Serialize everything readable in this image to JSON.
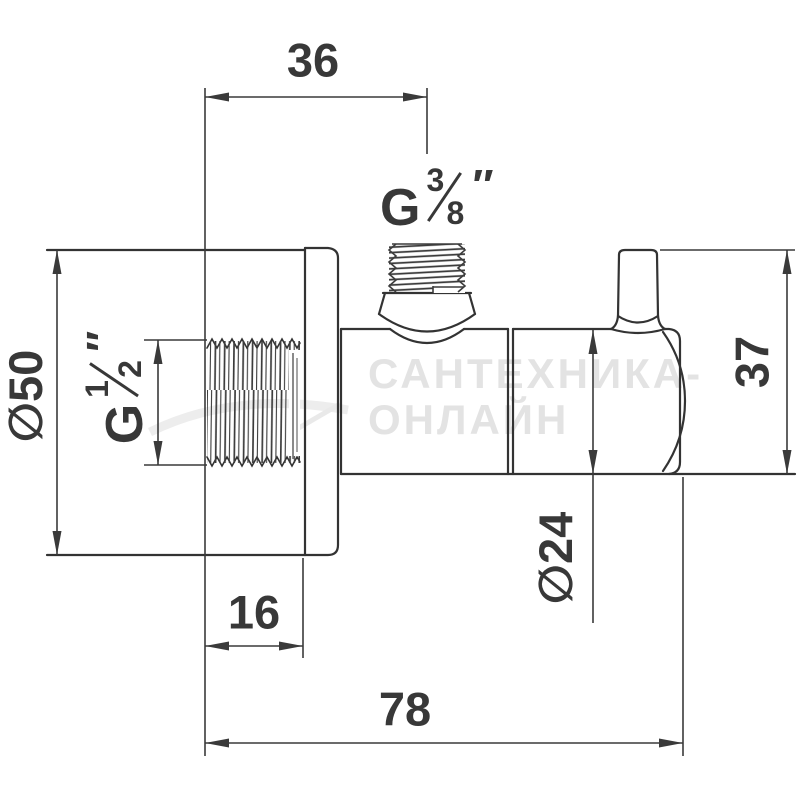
{
  "meta": {
    "type": "technical-dimension-drawing",
    "subject": "angle valve with wall flange, side view"
  },
  "labels": {
    "dim_top_offset": "36",
    "dim_flange_diameter": "∅50",
    "dim_right_height": "37",
    "dim_body_diameter": "∅24",
    "dim_flange_depth": "16",
    "dim_total_length": "78",
    "thread_top": {
      "prefix": "G",
      "numerator": "3",
      "denominator": "8",
      "unit": "″"
    },
    "thread_left": {
      "prefix": "G",
      "numerator": "1",
      "denominator": "2",
      "unit": "″"
    }
  },
  "watermark": {
    "line1": "САНТЕХНИКА-",
    "line2": "ОНЛАЙН"
  },
  "colors": {
    "line": "#333333",
    "dimension_line": "#3a3a3a",
    "text": "#383838",
    "watermark": "#e3e3e3",
    "background": "#ffffff"
  }
}
